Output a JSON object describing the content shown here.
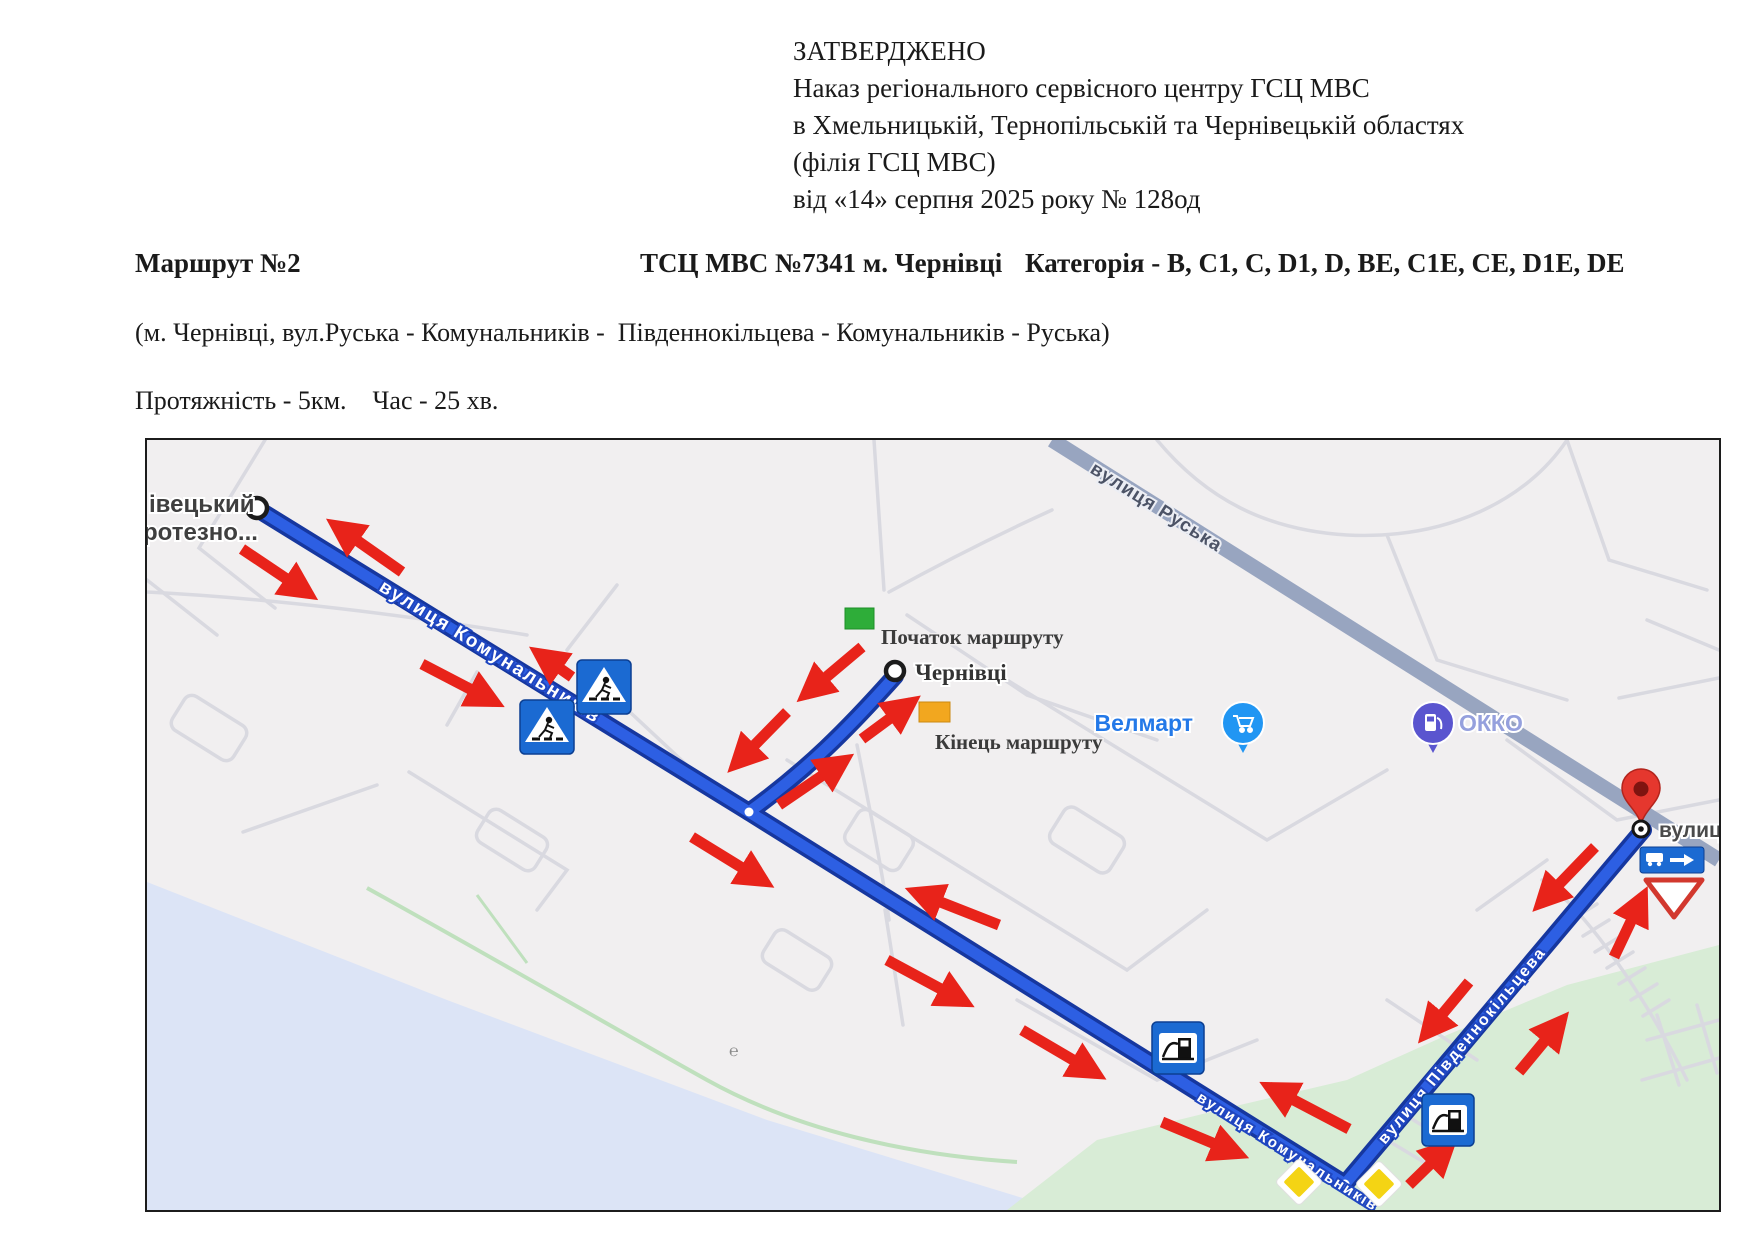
{
  "approval": {
    "lines": [
      "ЗАТВЕРДЖЕНО",
      "Наказ регіонального сервісного центру ГСЦ МВС",
      "в Хмельницькій, Тернопільській та Чернівецькій областях",
      "(філія ГСЦ МВС)",
      "від «14» серпня 2025 року № 128од"
    ]
  },
  "route_header": {
    "route_no": "Маршрут №2",
    "center": "ТСЦ МВС №7341 м. Чернівці",
    "category": "Категорія - B, C1, C, D1, D, BE, C1E, CE, D1E, DE"
  },
  "route_description": "(м. Чернівці, вул.Руська - Комунальників -  Південнокільцева - Комунальників - Руська)",
  "route_stats": "Протяжність - 5км.    Час - 25 хв.",
  "map": {
    "labels": {
      "start_cut_line1": "івецький",
      "start_cut_line2": "ротезно...",
      "city_marker": "Чернівці",
      "route_start": "Початок маршруту",
      "route_end": "Кінець маршруту",
      "poi_velmart": "Велмарт",
      "poi_okko": "ОККО",
      "street_ruska": "вулиця Руська",
      "street_komunalnykiv_upper": "вулиця Комунальників",
      "street_komunalnykiv_lower": "вулиця Комунальників",
      "street_pivdennokiltseva": "вулиця Південнокільцева",
      "street_cut_right": "вулиц"
    },
    "icons": {
      "pedestrian_crossing": "pedestrian-crossing-sign",
      "fuel_station": "fuel-station-sign",
      "priority_road": "priority-road-sign",
      "yield": "yield-sign",
      "one_way_info": "blue-info-sign",
      "destination_pin": "red-map-pin",
      "velmart": "shopping-cart-poi",
      "okko": "fuel-pump-poi"
    },
    "colors": {
      "route_blue": "#2d5fe3",
      "route_casing": "#16379f",
      "arrow_red": "#e8231a",
      "water": "#dce4f6",
      "green_area": "#d8ecd6",
      "sign_blue": "#1b6ad2",
      "start_green": "#2ead39",
      "end_orange": "#f2a71f",
      "ruska_road": "#98a5c0"
    }
  }
}
